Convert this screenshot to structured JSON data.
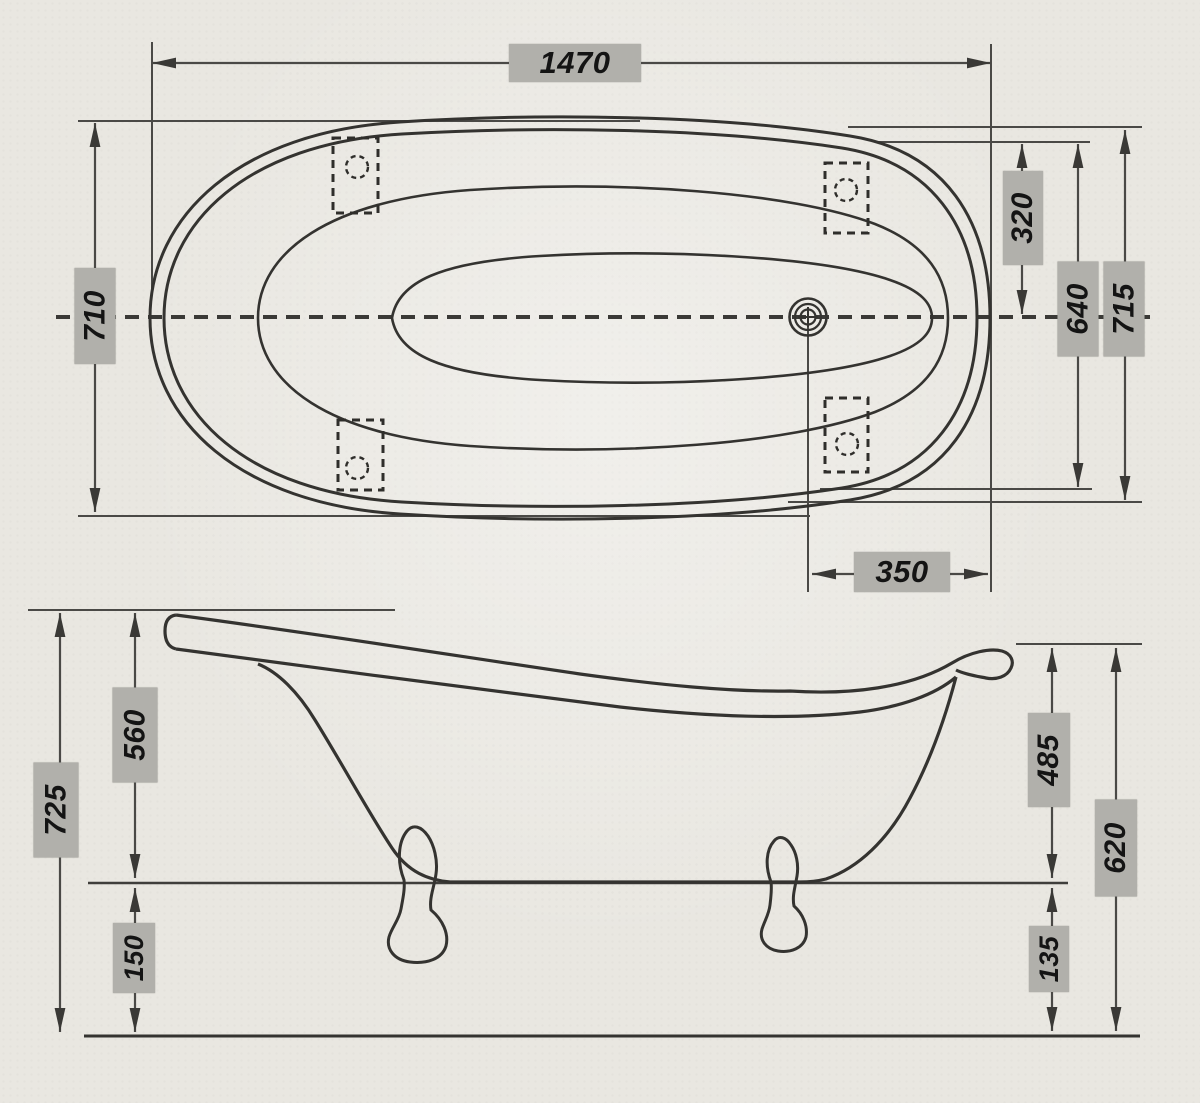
{
  "drawing": {
    "kind": "bathtub-dimension-diagram",
    "views": {
      "plan": "top-view",
      "elevation": "side-view"
    }
  },
  "dims": {
    "plan": {
      "length": "1470",
      "width_left": "710",
      "center_offset": "320",
      "inner_span": "640",
      "width_right": "715",
      "drain_offset": "350"
    },
    "side": {
      "overall_left": "725",
      "body_left": "560",
      "clearance_left": "150",
      "body_right": "485",
      "clearance_right": "135",
      "overall_right": "620"
    }
  },
  "colors": {
    "paper": "#e9e7e1",
    "outline": "#343330",
    "dimension_line": "#4a4946",
    "arrow": "#3a3936",
    "label_background": "#b1b0ab",
    "label_text": "#141414"
  }
}
